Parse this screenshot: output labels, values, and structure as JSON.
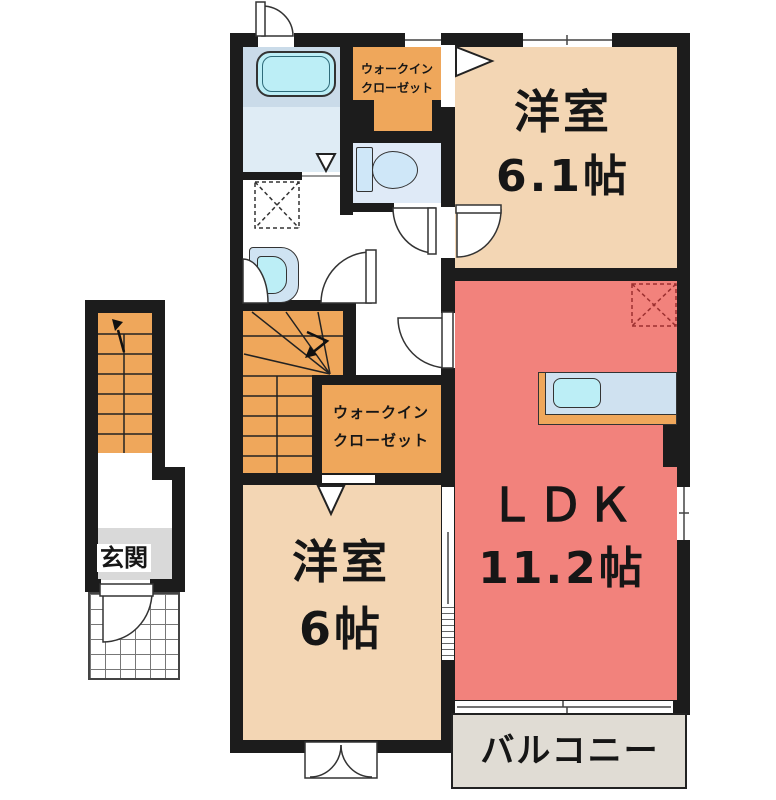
{
  "floorplan": {
    "rooms": {
      "western_room_top": {
        "name": "洋室",
        "size": "6.1帖"
      },
      "ldk": {
        "name": "ＬＤＫ",
        "size": "11.2帖"
      },
      "western_room_bottom": {
        "name": "洋室",
        "size": "6帖"
      },
      "walk_in_closet_top": {
        "line1": "ウォークイン",
        "line2": "クローゼット"
      },
      "walk_in_closet_middle": {
        "line1": "ウォークイン",
        "line2": "クローゼット"
      },
      "entrance": {
        "name": "玄関"
      },
      "balcony": {
        "name": "バルコニー"
      }
    },
    "icons": {
      "door-swing-icon": "white quarter-arc sector",
      "stairs-up-arrow-icon": "bent polyline with arrowhead",
      "washing-machine-space-icon": "black dashed box with X",
      "refrigerator-space-icon": "red dashed box with X",
      "folding-door-icon": "white triangle"
    },
    "colors": {
      "wall": "#1c1c1c",
      "western_room": "#f3d6b4",
      "ldk": "#f2827c",
      "closet_stairs_orange": "#efa75b",
      "bath_floor": "#cadbe9",
      "bath_floor_light": "#dfecf5",
      "toilet_floor": "#dfeaf7",
      "fixture_blue": "#bceef6",
      "counter_top": "#cfe1f0",
      "balcony_floor": "#e0dcd4",
      "entrance_floor": "#d9d9d9"
    }
  }
}
